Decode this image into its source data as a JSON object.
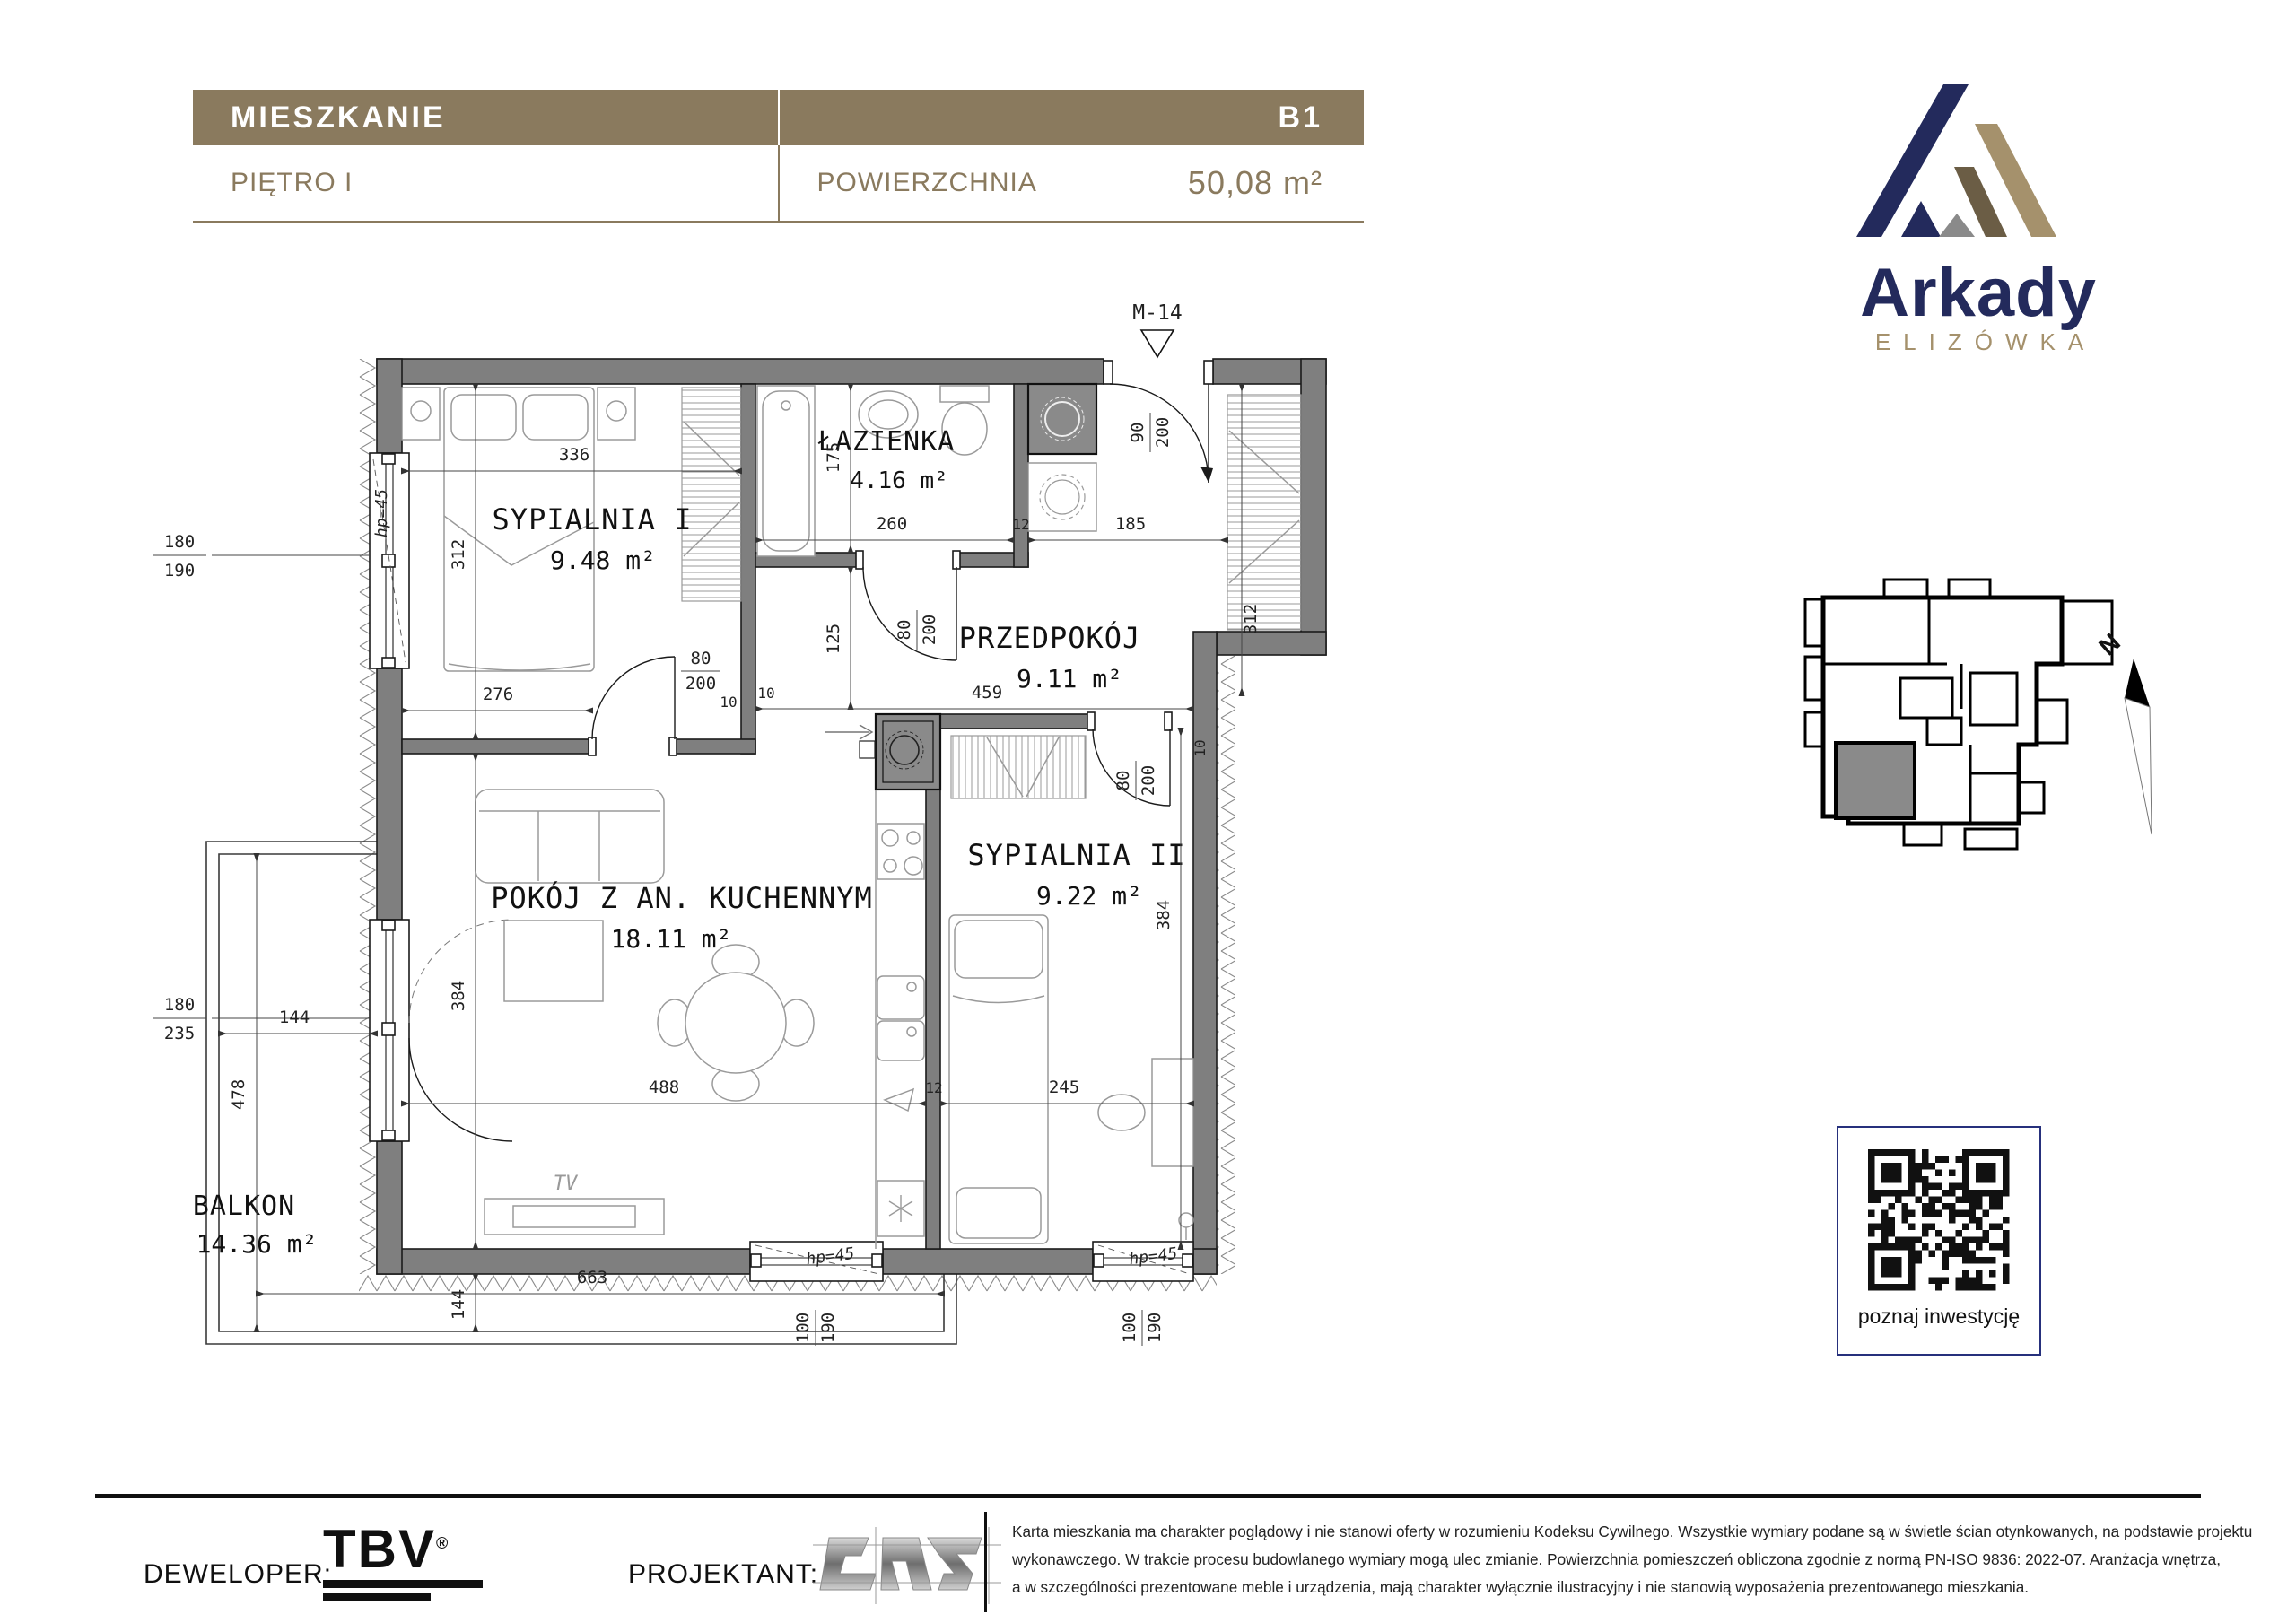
{
  "header": {
    "title": "MIESZKANIE",
    "floor": "PIĘTRO I",
    "unit": "B1",
    "area_label": "POWIERZCHNIA",
    "area_value": "50,08 m²"
  },
  "brand": {
    "name": "Arkady",
    "subtitle": "ELIZÓWKA"
  },
  "plan": {
    "marker": "M-14",
    "rooms": {
      "bedroom1": {
        "name": "SYPIALNIA I",
        "area": "9.48 m²"
      },
      "bathroom": {
        "name": "ŁAZIENKA",
        "area": "4.16 m²"
      },
      "hall": {
        "name": "PRZEDPOKÓJ",
        "area": "9.11 m²"
      },
      "living": {
        "name": "POKÓJ Z AN. KUCHENNYM",
        "area": "18.11 m²"
      },
      "bedroom2": {
        "name": "SYPIALNIA II",
        "area": "9.22 m²"
      },
      "balcony": {
        "name": "BALKON",
        "area": "14.36 m²"
      }
    },
    "dims": {
      "d336": "336",
      "d312": "312",
      "d276": "276",
      "d175": "175",
      "d260": "260",
      "d125": "125",
      "d459": "459",
      "d185": "185",
      "d384": "384",
      "d488": "488",
      "d245": "245",
      "d478": "478",
      "d144": "144",
      "d663": "663",
      "d80": "80",
      "d90": "90",
      "d100": "100",
      "d200": "200",
      "d190": "190",
      "d180": "180",
      "d235": "235",
      "d12": "12",
      "d10": "10",
      "hp": "hp=45",
      "tv": "TV"
    }
  },
  "locator": {
    "compass": "N"
  },
  "qr": {
    "caption": "poznaj inwestycję"
  },
  "footer": {
    "developer_label": "DEWELOPER:",
    "developer_logo": "TBV",
    "registered": "®",
    "designer_label": "PROJEKTANT:",
    "disclaimer_line1": "Karta mieszkania ma charakter poglądowy i nie stanowi oferty w rozumieniu Kodeksu Cywilnego. Wszystkie wymiary podane są w świetle ścian otynkowanych, na podstawie projektu",
    "disclaimer_line2": "wykonawczego. W trakcie procesu budowlanego wymiary mogą ulec zmianie. Powierzchnia pomieszczeń obliczona zgodnie z normą PN-ISO 9836: 2022-07. Aranżacja wnętrza,",
    "disclaimer_line3": "a w szczególności prezentowane meble i urządzenia, mają charakter wyłącznie ilustracyjny i nie stanowią wyposażenia prezentowanego mieszkania."
  }
}
